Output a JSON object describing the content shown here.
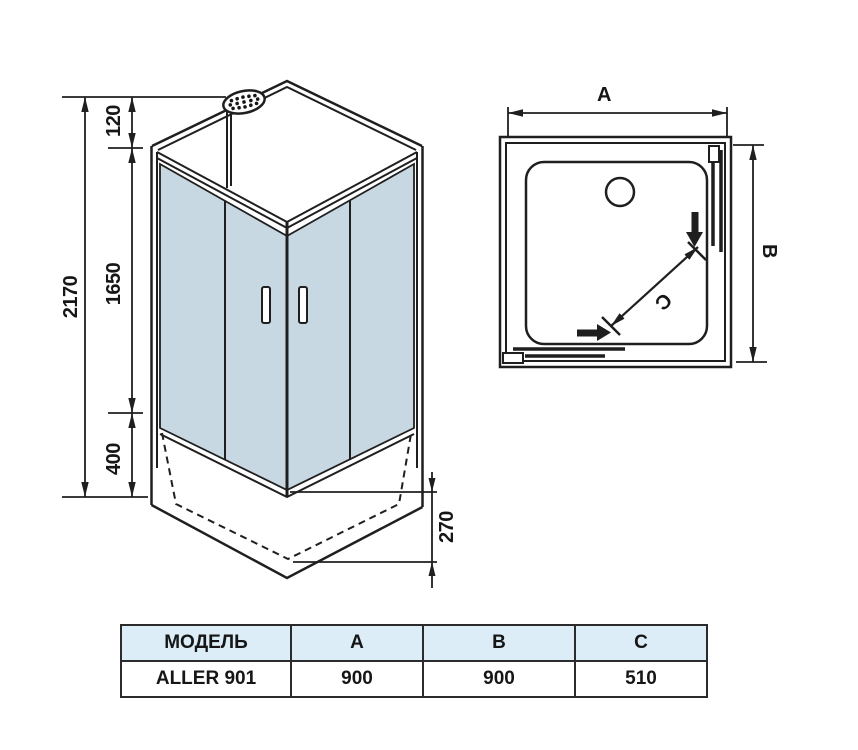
{
  "front_view": {
    "total_height": "2170",
    "top_offset": "120",
    "glass_height": "1650",
    "base_height": "400",
    "tray_depth": "270"
  },
  "top_view": {
    "width_label": "A",
    "depth_label": "B",
    "door_label": "C"
  },
  "table": {
    "headers": [
      "МОДЕЛЬ",
      "A",
      "B",
      "C"
    ],
    "rows": [
      [
        "ALLER 901",
        "900",
        "900",
        "510"
      ]
    ]
  },
  "colors": {
    "glass": "#c7d8e2",
    "table_header_bg": "#dcedf7",
    "line": "#1f1f1f"
  }
}
